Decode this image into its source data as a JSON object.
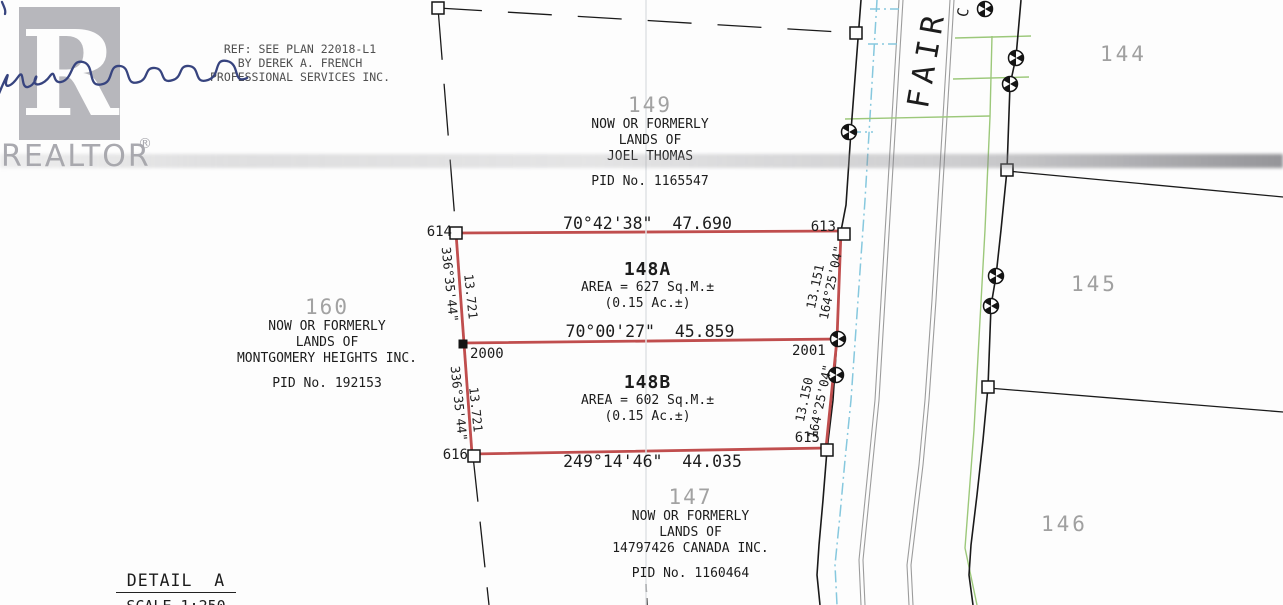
{
  "watermark": {
    "logo_letter": "R",
    "brand": "REALTOR",
    "registered": "®"
  },
  "reference_note": {
    "line1": "REF: SEE PLAN 22018-L1",
    "line2": "BY DEREK A. FRENCH",
    "line3": "PROFESSIONAL SERVICES INC."
  },
  "parcels": {
    "north": {
      "lot": "149",
      "line1": "NOW OR FORMERLY",
      "line2": "LANDS OF",
      "line3": "JOEL THOMAS",
      "pid": "PID No. 1165547"
    },
    "west": {
      "lot": "160",
      "line1": "NOW OR FORMERLY",
      "line2": "LANDS OF",
      "line3": "MONTGOMERY HEIGHTS INC.",
      "pid": "PID No. 192153"
    },
    "south": {
      "lot": "147",
      "line1": "NOW OR FORMERLY",
      "line2": "LANDS OF",
      "line3": "14797426 CANADA INC.",
      "pid": "PID No. 1160464"
    },
    "east_top": "144",
    "east_middle": "145",
    "east_bottom": "146"
  },
  "lots": {
    "lot_a": {
      "name": "148A",
      "area": "AREA = 627 Sq.M.±",
      "acres": "(0.15 Ac.±)"
    },
    "lot_b": {
      "name": "148B",
      "area": "AREA = 602 Sq.M.±",
      "acres": "(0.15 Ac.±)"
    }
  },
  "dimensions": {
    "north_line": "70°42'38\"  47.690",
    "middle_line": "70°00'27\"  45.859",
    "south_line": "249°14'46\"  44.035",
    "west_upper_bearing": "336°35'44\"",
    "west_upper_distance": "13.721",
    "west_lower_bearing": "336°35'44\"",
    "west_lower_distance": "13.721",
    "east_upper_distance": "13.151",
    "east_upper_bearing": "164°25'04\"",
    "east_lower_distance": "13.150",
    "east_lower_bearing": "164°25'04\""
  },
  "survey_points": {
    "p614": "614",
    "p613": "613",
    "p2000": "2000",
    "p2001": "2001",
    "p616": "616",
    "p615": "615"
  },
  "street": {
    "name": "FAIR",
    "cutoff": "C"
  },
  "detail": {
    "title": "DETAIL  A",
    "scale": "SCALE 1:250"
  },
  "colors": {
    "boundary_red": "#c04e4e",
    "water_cyan": "#86c8de",
    "utility_green": "#9cc87a",
    "curb_gray": "#9c9c9c",
    "faded_label_gray": "#a0a0a0",
    "watermark_gray": "#b7b7bc",
    "signature_ink_blue": "#37447f"
  }
}
